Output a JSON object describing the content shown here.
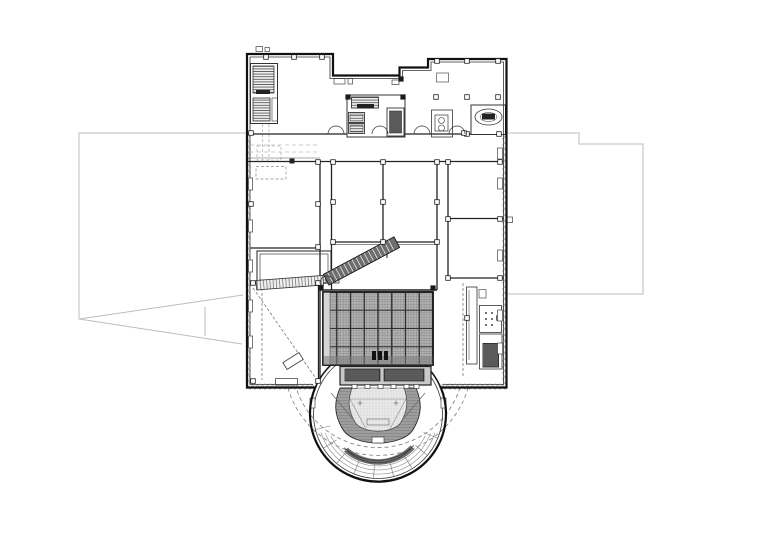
{
  "page": {
    "background_color": "#ffffff",
    "description": "Black-and-white CAD architectural floor plan of a theatre / concert hall level"
  },
  "drawing": {
    "title": "Architectural floor plan — theatre level with stage fly grid and horseshoe auditorium",
    "type": "architectural-floor-plan",
    "canvas": {
      "width_px": 780,
      "height_px": 551
    },
    "colors": {
      "background": "#ffffff",
      "wall_line": "#1a1a1a",
      "interior_line": "#333333",
      "faint_line": "#8c8c8c",
      "site_boundary": "#bdbdbd",
      "stage_grid_fill": "#b4b4b4",
      "stage_grid_lines": "#2f2f2f",
      "balcony_band": "#9d9d9d",
      "stair_fill": "#6e6e6e",
      "floor_hatch": "#e8e8e8"
    },
    "elements": [
      {
        "name": "site-boundary-left",
        "kind": "thin gray property/roof outline left of building"
      },
      {
        "name": "site-boundary-right",
        "kind": "thin gray property/roof outline right of building"
      },
      {
        "name": "site-wedge",
        "kind": "gray wedge converging to a point at far left"
      },
      {
        "name": "building-outline",
        "kind": "stepped rectangular perimeter with insulated walls"
      },
      {
        "name": "stair-core-top-left",
        "kind": "hatched stair flights with shaft"
      },
      {
        "name": "central-core",
        "kind": "stair, two elevator cells and service shaft"
      },
      {
        "name": "spiral-stair-room",
        "kind": "oval stair in top-right block"
      },
      {
        "name": "mid-rooms",
        "kind": "rehearsal / plant rooms with column grid"
      },
      {
        "name": "diagonal-stair",
        "kind": "dark escalator/stair running at an angle onto the grid"
      },
      {
        "name": "stage-fly-grid",
        "kind": "dense dark crosshatched stage grid"
      },
      {
        "name": "proscenium-band",
        "kind": "dark stage-machinery strip between grid and hall"
      },
      {
        "name": "auditorium",
        "kind": "circular hall, double wall, dashed outer arcs"
      },
      {
        "name": "balcony-horseshoe",
        "kind": "gray hatched horseshoe balcony around orchestra floor"
      },
      {
        "name": "seating-arcs",
        "kind": "concentric seating rows with radial spokes"
      },
      {
        "name": "service-corridor-right",
        "kind": "shaft, call-button panel and dark service elevator"
      }
    ]
  }
}
